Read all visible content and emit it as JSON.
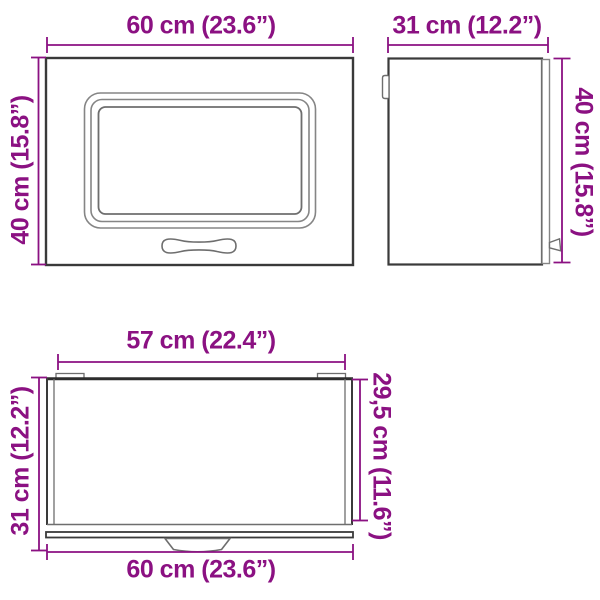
{
  "diagram": {
    "subject": "wall-cabinet-dimension-diagram",
    "views": {
      "front": {
        "width_label": "60 cm (23.6”)",
        "height_label": "40 cm (15.8”)"
      },
      "side": {
        "depth_label": "31 cm (12.2”)",
        "height_label": "40 cm (15.8”)"
      },
      "top": {
        "inner_width_label": "57 cm (22.4”)",
        "total_depth_label": "31 cm (12.2”)",
        "body_depth_label": "29,5 cm (11.6”)",
        "outer_width_label": "60 cm (23.6”)"
      }
    },
    "colors": {
      "dimension": "#8b1182",
      "outline_dark": "#3a3a3a",
      "outline_mid": "#6e6e6e",
      "outline_light": "#858585"
    }
  }
}
